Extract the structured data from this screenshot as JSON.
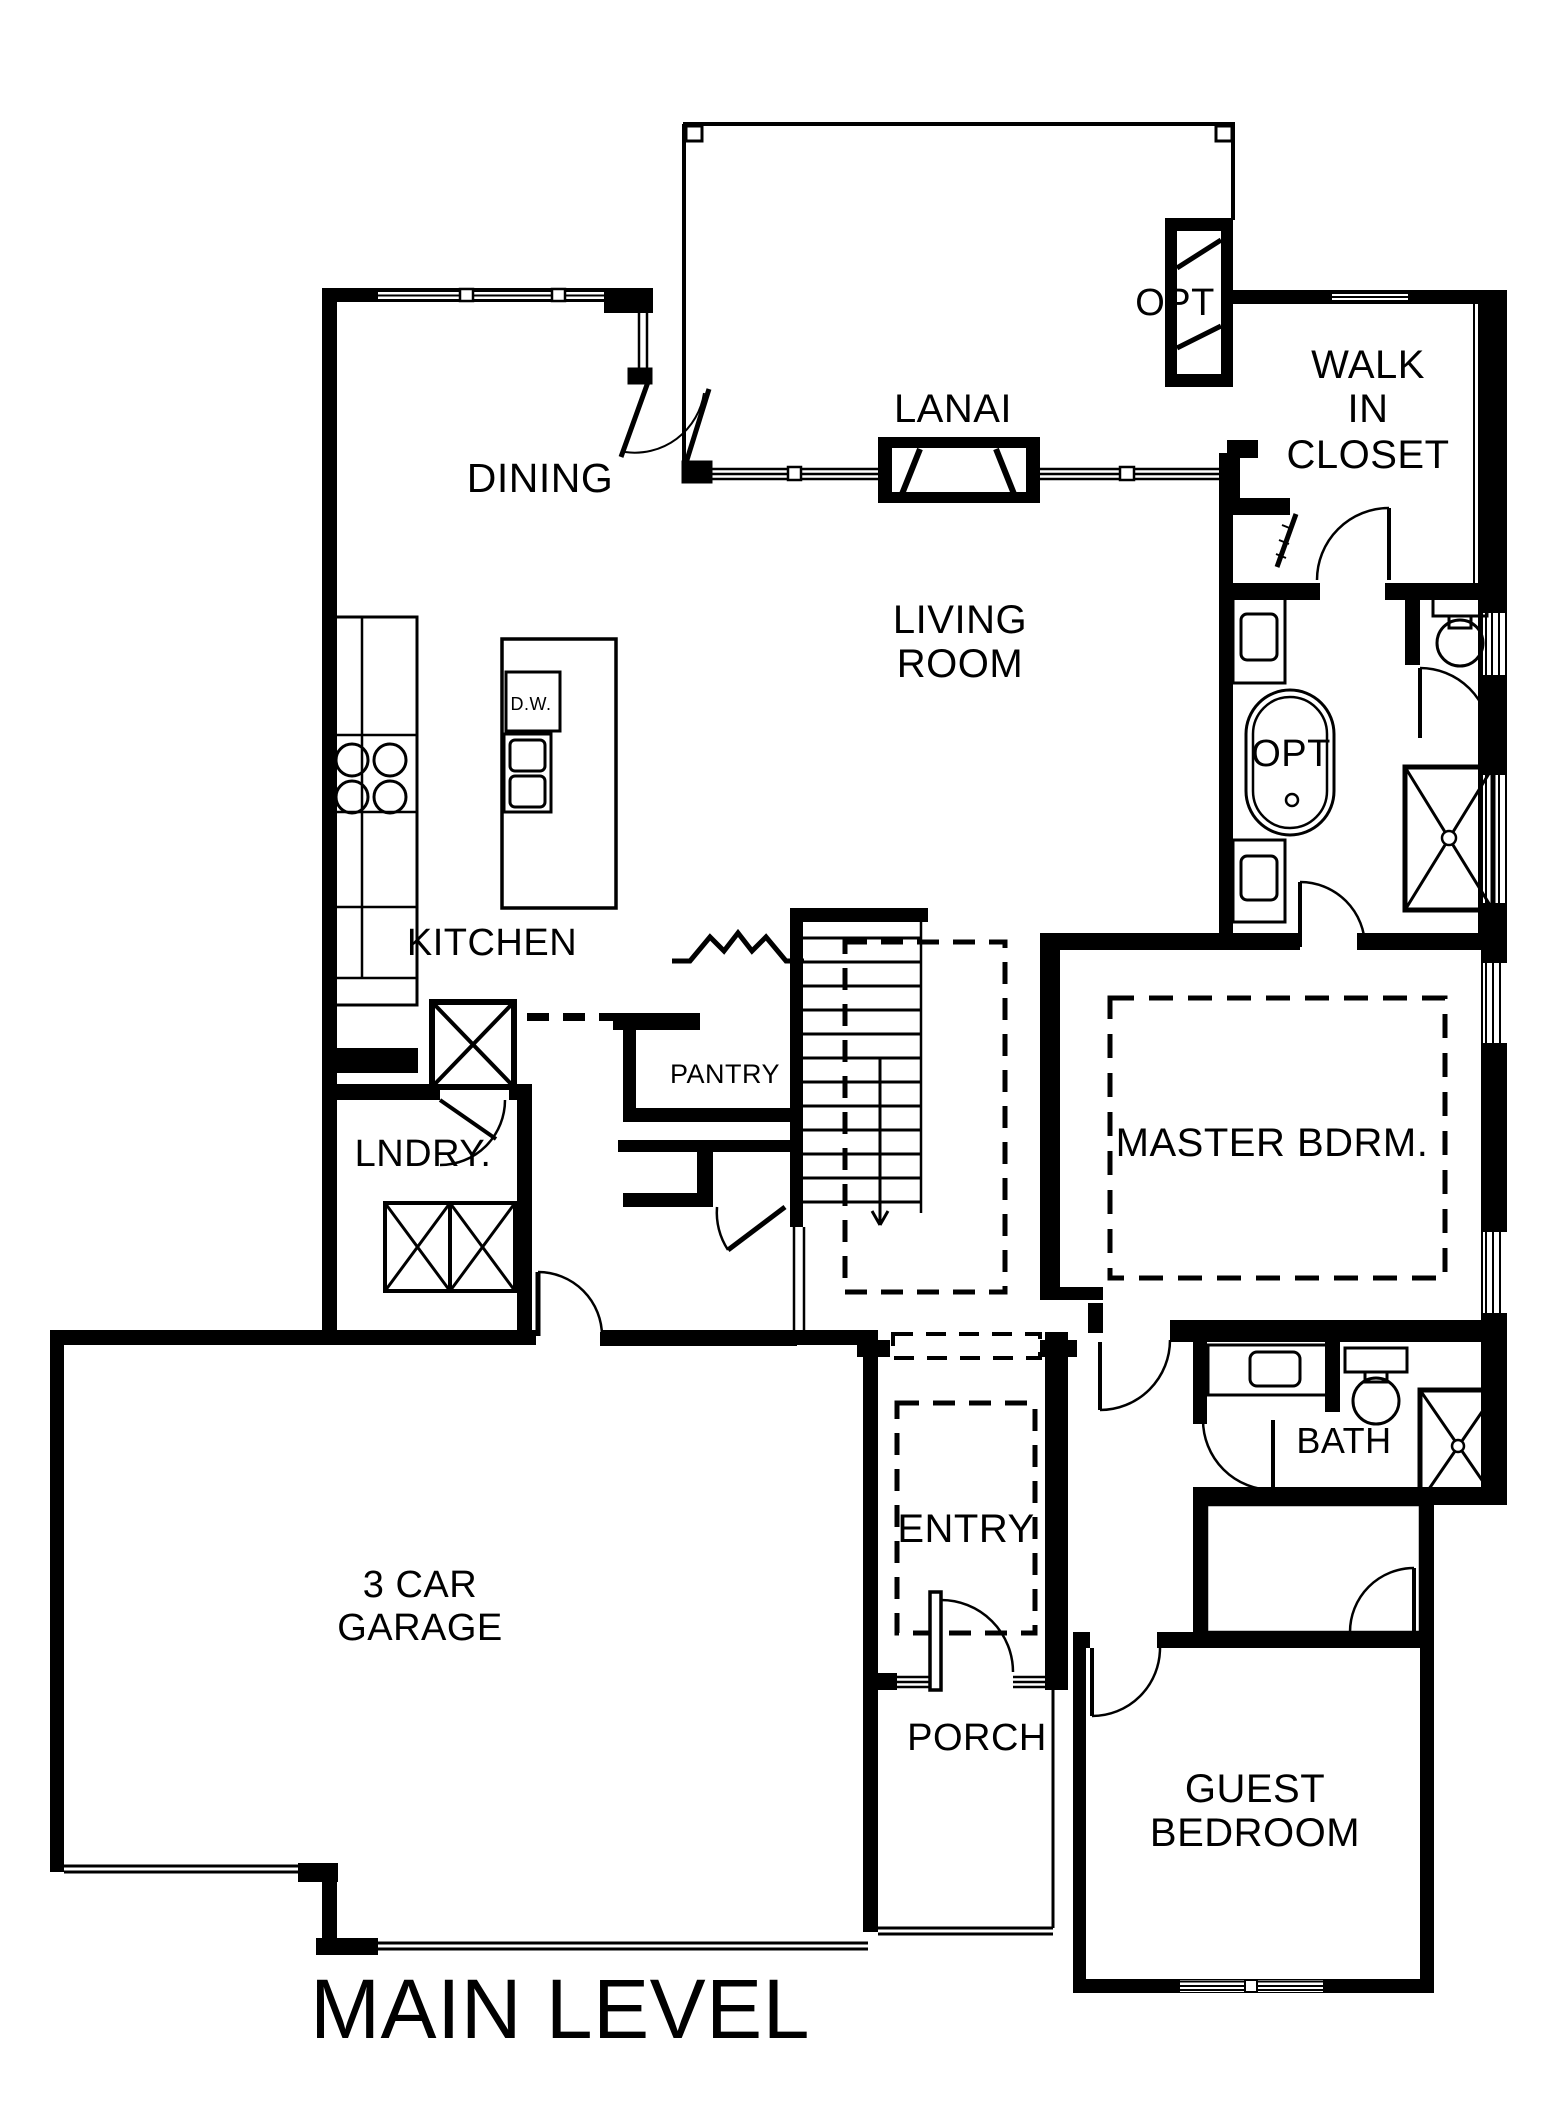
{
  "plan": {
    "title": "MAIN LEVEL",
    "level_name": "MAIN LEVEL"
  },
  "labels": {
    "lanai": "LANAI",
    "opt_fireplace": "OPT",
    "walk_in_closet_line1": "WALK",
    "walk_in_closet_line2": "IN",
    "walk_in_closet_line3": "CLOSET",
    "dining": "DINING",
    "living_line1": "LIVING",
    "living_line2": "ROOM",
    "kitchen": "KITCHEN",
    "dishwasher": "D.W.",
    "opt_tub": "OPT",
    "pantry": "PANTRY",
    "laundry": "LNDRY.",
    "master_bedroom": "MASTER BDRM.",
    "garage_line1": "3 CAR",
    "garage_line2": "GARAGE",
    "entry": "ENTRY",
    "bath": "BATH",
    "porch": "PORCH",
    "guest_line1": "GUEST",
    "guest_line2": "BEDROOM"
  },
  "colors": {
    "wall": "#000000",
    "background": "#ffffff"
  }
}
